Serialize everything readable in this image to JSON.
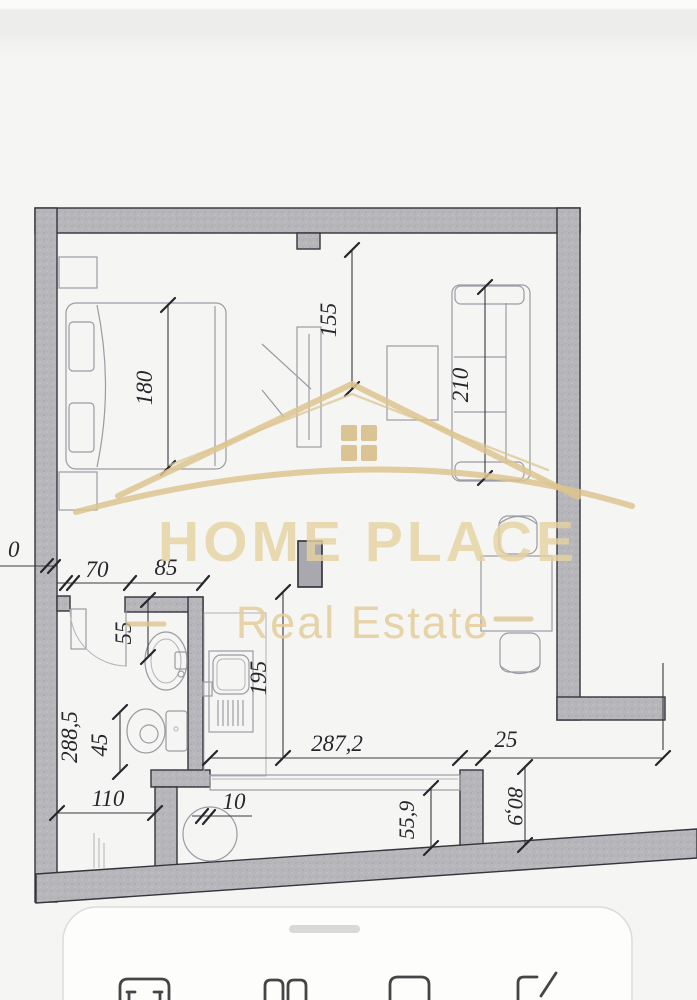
{
  "watermark": {
    "brand": "HOME PLACE",
    "tagline": "Real Estate",
    "gold_color": "#dcc48e",
    "logo": "house-roof-with-window"
  },
  "floor_plan": {
    "wall_color": "#b6b6ba",
    "line_color": "#33333a",
    "dimension_labels": {
      "bed_width": "180",
      "tv_wall_offset": "155",
      "sofa_length": "210",
      "zero_mark": "0",
      "entry_door_width": "70",
      "bathroom_width": "85",
      "sink_offset": "55",
      "toilet_offset": "45",
      "bathroom_length": "288,5",
      "hall_width": "110",
      "appliance_offset": "10",
      "kitchen_depth": "195",
      "room_width": "287,2",
      "pier_width": "25",
      "niche_depth": "55,9",
      "ledge_depth": "80,9"
    },
    "furniture": [
      "bed",
      "nightstands",
      "tv-stand",
      "sofa",
      "side-table",
      "desk",
      "chairs",
      "bath-sink",
      "toilet",
      "kitchen-sink",
      "counter",
      "washing-machine"
    ]
  },
  "bottom_sheet": {
    "drag_handle": "pill",
    "toolbar_icons": [
      "scan-icon",
      "copy-icon",
      "folder-icon",
      "markup-icon"
    ]
  }
}
